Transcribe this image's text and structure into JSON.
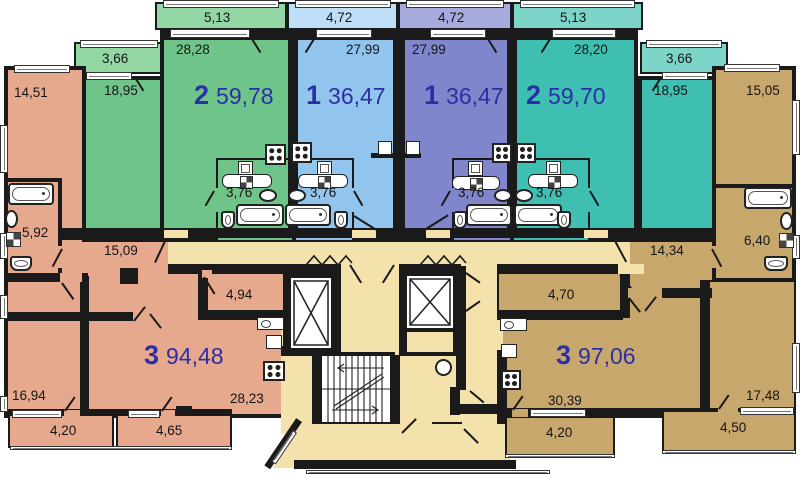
{
  "colors": {
    "green": "#6FC589",
    "green-light": "#93D8A4",
    "blue": "#92C5EE",
    "blue-light": "#BEDFF7",
    "purple": "#8086CB",
    "purple-light": "#A6AADD",
    "teal": "#3FBFB1",
    "teal-light": "#7DD4C8",
    "salmon": "#E7A98E",
    "tan": "#C8A76D",
    "cream": "#F4E2AD",
    "wall": "#1a1a1a",
    "apartment-label": "#2b2fa6",
    "room-label": "#151515"
  },
  "apartments": [
    {
      "id": "apt-2-left",
      "rooms": "2",
      "area": "59,78"
    },
    {
      "id": "apt-1-left",
      "rooms": "1",
      "area": "36,47"
    },
    {
      "id": "apt-1-right",
      "rooms": "1",
      "area": "36,47"
    },
    {
      "id": "apt-2-right",
      "rooms": "2",
      "area": "59,70"
    },
    {
      "id": "apt-3-left",
      "rooms": "3",
      "area": "94,48"
    },
    {
      "id": "apt-3-right",
      "rooms": "3",
      "area": "97,06"
    }
  ],
  "labels": {
    "balc_513_l": "5,13",
    "balc_472_l": "4,72",
    "balc_472_r": "4,72",
    "balc_513_r": "5,13",
    "balc_366_l": "3,66",
    "balc_366_r": "3,66",
    "room_1451": "14,51",
    "room_2828": "28,28",
    "room_1895_l": "18,95",
    "room_2799_l": "27,99",
    "room_2799_r": "27,99",
    "room_2820": "28,20",
    "room_1895_r": "18,95",
    "room_1505": "15,05",
    "bath_376_green": "3,76",
    "bath_376_blue": "3,76",
    "bath_376_purple": "3,76",
    "bath_376_teal": "3,76",
    "bath_592": "5,92",
    "bath_640": "6,40",
    "hall_1509": "15,09",
    "hall_1434": "14,34",
    "room_494": "4,94",
    "room_470": "4,70",
    "room_1694": "16,94",
    "room_2823": "28,23",
    "room_3039": "30,39",
    "room_1748": "17,48",
    "balc_420_l": "4,20",
    "balc_465": "4,65",
    "balc_420_r": "4,20",
    "balc_450": "4,50"
  }
}
